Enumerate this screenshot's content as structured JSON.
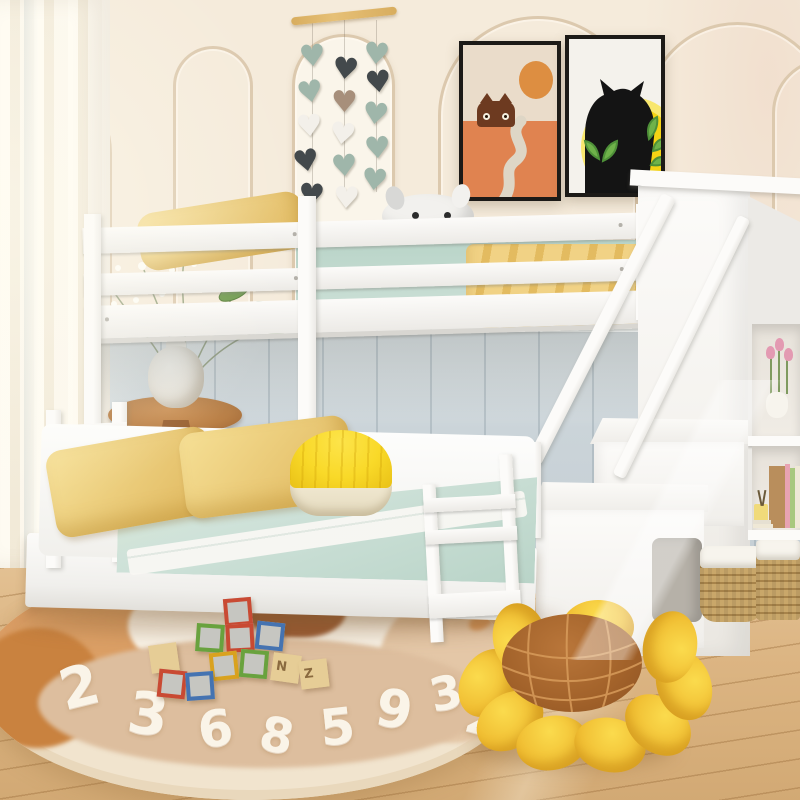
{
  "scene": {
    "subject": "white twin-over-full bunk bed with storage staircase in a kids bedroom",
    "objects": [
      "sheer-curtain",
      "arched-wall-molding",
      "heart-garland",
      "cat-posters",
      "top-bunk",
      "bottom-bed",
      "storage-staircase",
      "bookshelf-cubbies",
      "wicker-baskets",
      "number-rug",
      "toy-blocks",
      "sunflower-floor-pillow",
      "side-table-with-vase"
    ]
  },
  "palette": {
    "wall": "#f5ebdb",
    "wallDeep": "#efe0cb",
    "trim": "#dcc9ae",
    "archFill": "#faf5ea",
    "panel": "#cbd4d9",
    "panelLight": "#edf0ee",
    "floor": "#e5c497",
    "floorDeep": "#d2a974",
    "white": "#fcfbf9",
    "whiteShade": "#eceae6",
    "whiteDeep": "#d8d6d1",
    "mint": "#cfe2d9",
    "mintDeep": "#b9d4c8",
    "pillowYellow": "#f2d78b",
    "pillowDeep": "#dfb65c",
    "blanketYellow": "#f1d285",
    "blanketDeep": "#e3bb60",
    "poufTop": "#f9d928",
    "poufBase": "#f1e9d2",
    "stick": "#d8ad5e",
    "heartSage": "#9fb6aa",
    "heartDark": "#43494c",
    "heartWhite": "#f3f0ea",
    "heartTaupe": "#a78f7b",
    "frame": "#1c1a17",
    "posterBeige": "#eadcca",
    "posterOrange": "#dd8e41",
    "posterGround": "#e08350",
    "catBrown": "#6d3a20",
    "pathGray": "#ded6c6",
    "posterWhite": "#f4f2ec",
    "sunYellow": "#f5d314",
    "sunLight": "#f8e76e",
    "catBlack": "#141414",
    "leaf": "#6fb24a",
    "leafDark": "#4e9038",
    "rugBase": "#f1e4ce",
    "rugEdge": "#e9d8bc",
    "rugTan": "#ddbe9e",
    "rugTanLight": "#e4c7a7",
    "rugOrange": "#d9975a",
    "rugOrangeDeep": "#c9823f",
    "rugBrown": "#9a5b33",
    "rugWhite": "#faf4e8",
    "tableWood": "#b97f46",
    "tableWoodDark": "#9a6233",
    "vase": "#f1ece2",
    "basket": "#c9a76a",
    "basketDark": "#a7834a",
    "liner": "#f7f4ed",
    "bag": "#b6b1a8",
    "blockWood": "#e6cd96",
    "blockRed": "#c94a33",
    "blockGreen": "#69a23e",
    "blockBlue": "#4573b1",
    "blockYellow": "#d9a21f",
    "blockFace": "#c6c6c1",
    "letterBrown": "#8a6a3f",
    "flowerDeep": "#eaae24",
    "flowerCenter": "#a2622a",
    "flowerLine": "#d79c5b",
    "tulipPink": "#e39ab2",
    "bookA": "#e6e0d2",
    "bookB": "#e8a3b2",
    "bookC": "#a8c87e",
    "bookD": "#efe8d6",
    "bookE": "#8cbaa2",
    "boxBrown": "#b98e5c",
    "jarYellow": "#f0da7a",
    "plushWhite": "#f2f1ee",
    "plushGray": "#d8d8d6",
    "plushPink": "#eed2da"
  },
  "rug": {
    "numbers": [
      "2",
      "3",
      "6",
      "8",
      "5",
      "9",
      "3",
      "2"
    ]
  },
  "blocks": {
    "letters": [
      "N",
      "Z"
    ]
  },
  "hearts": {
    "count": 15
  }
}
